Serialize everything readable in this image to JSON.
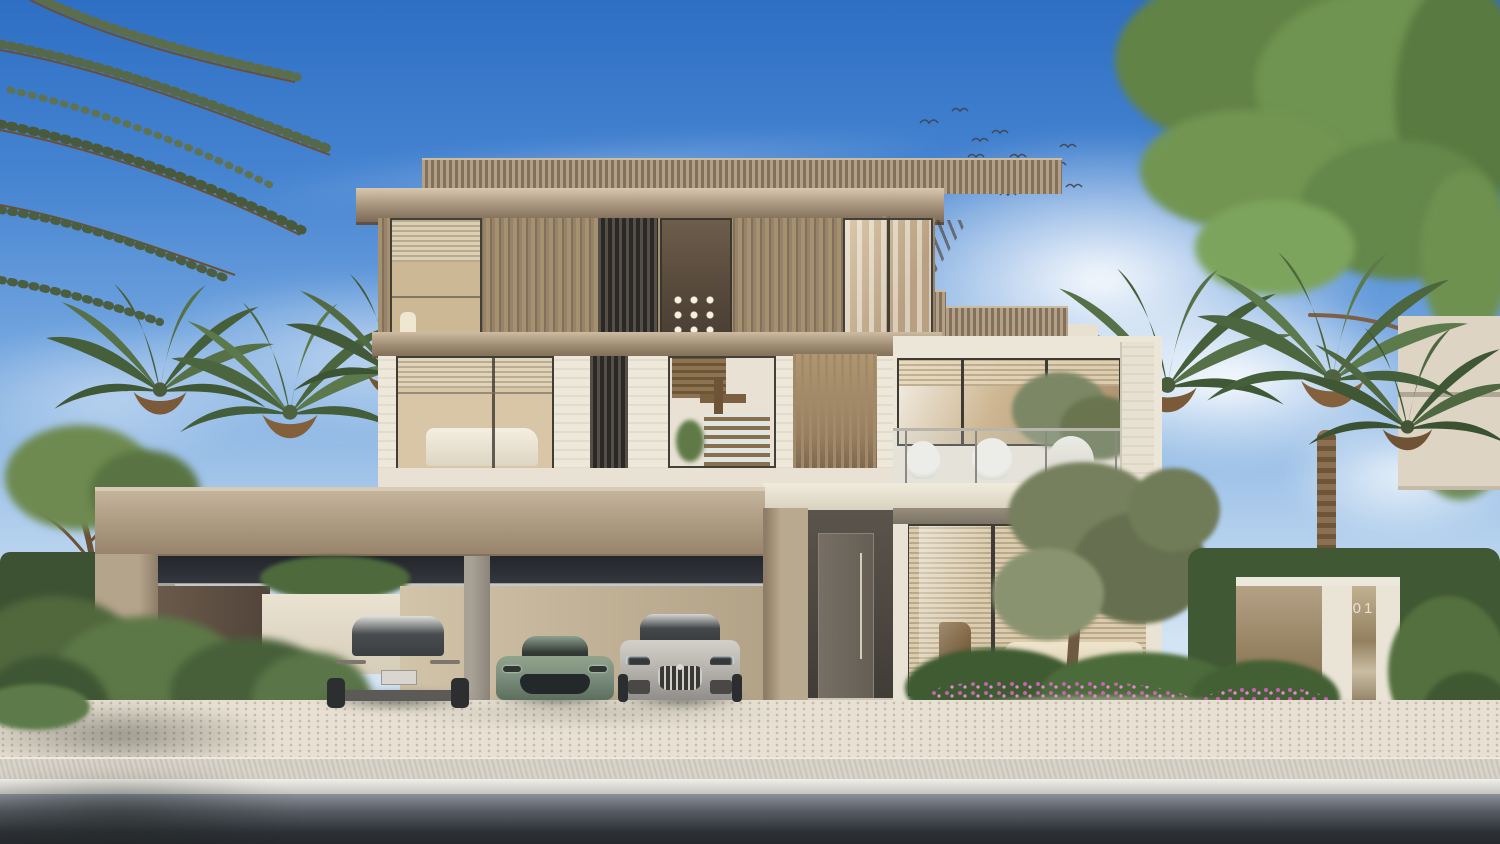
{
  "scene": {
    "setting": "photorealistic exterior rendering of a modern three-storey luxury villa at daytime",
    "sky": "clear blue sky with soft white clouds and a flock of birds",
    "visible_text": [
      "01"
    ]
  },
  "gate": {
    "number": "01"
  },
  "villa": {
    "floors": 3,
    "materials": [
      "timber slat cladding",
      "travertine stone",
      "bronze metal fascia",
      "floor-to-ceiling glass"
    ],
    "features": [
      "rooftop pergola",
      "glass balustrade balcony with two lounge chairs",
      "double carport",
      "recessed entrance door",
      "ground floor glass lounge with blinds"
    ]
  },
  "carport": {
    "car_count": 3
  },
  "cars": [
    {
      "id": "car-silver-rear",
      "view": "rear",
      "color": "#cecdc9"
    },
    {
      "id": "car-green-sports",
      "view": "front",
      "color": "#7e907f"
    },
    {
      "id": "car-silver-front",
      "view": "front",
      "color": "#c4c1bb"
    }
  ],
  "vegetation": {
    "palm_trees": 6,
    "olive_trees": 2,
    "street_tree_top_right": true,
    "flower_color": "#c06ab0",
    "hedges": true
  },
  "palette": {
    "sky_top": "#3374c8",
    "sky_horizon": "#cfe2f1",
    "timber": "#9c8768",
    "stone_white": "#ece6d8",
    "bronze": "#8c7a62",
    "paving": "#e7e0d2",
    "road": "#2e3237"
  }
}
